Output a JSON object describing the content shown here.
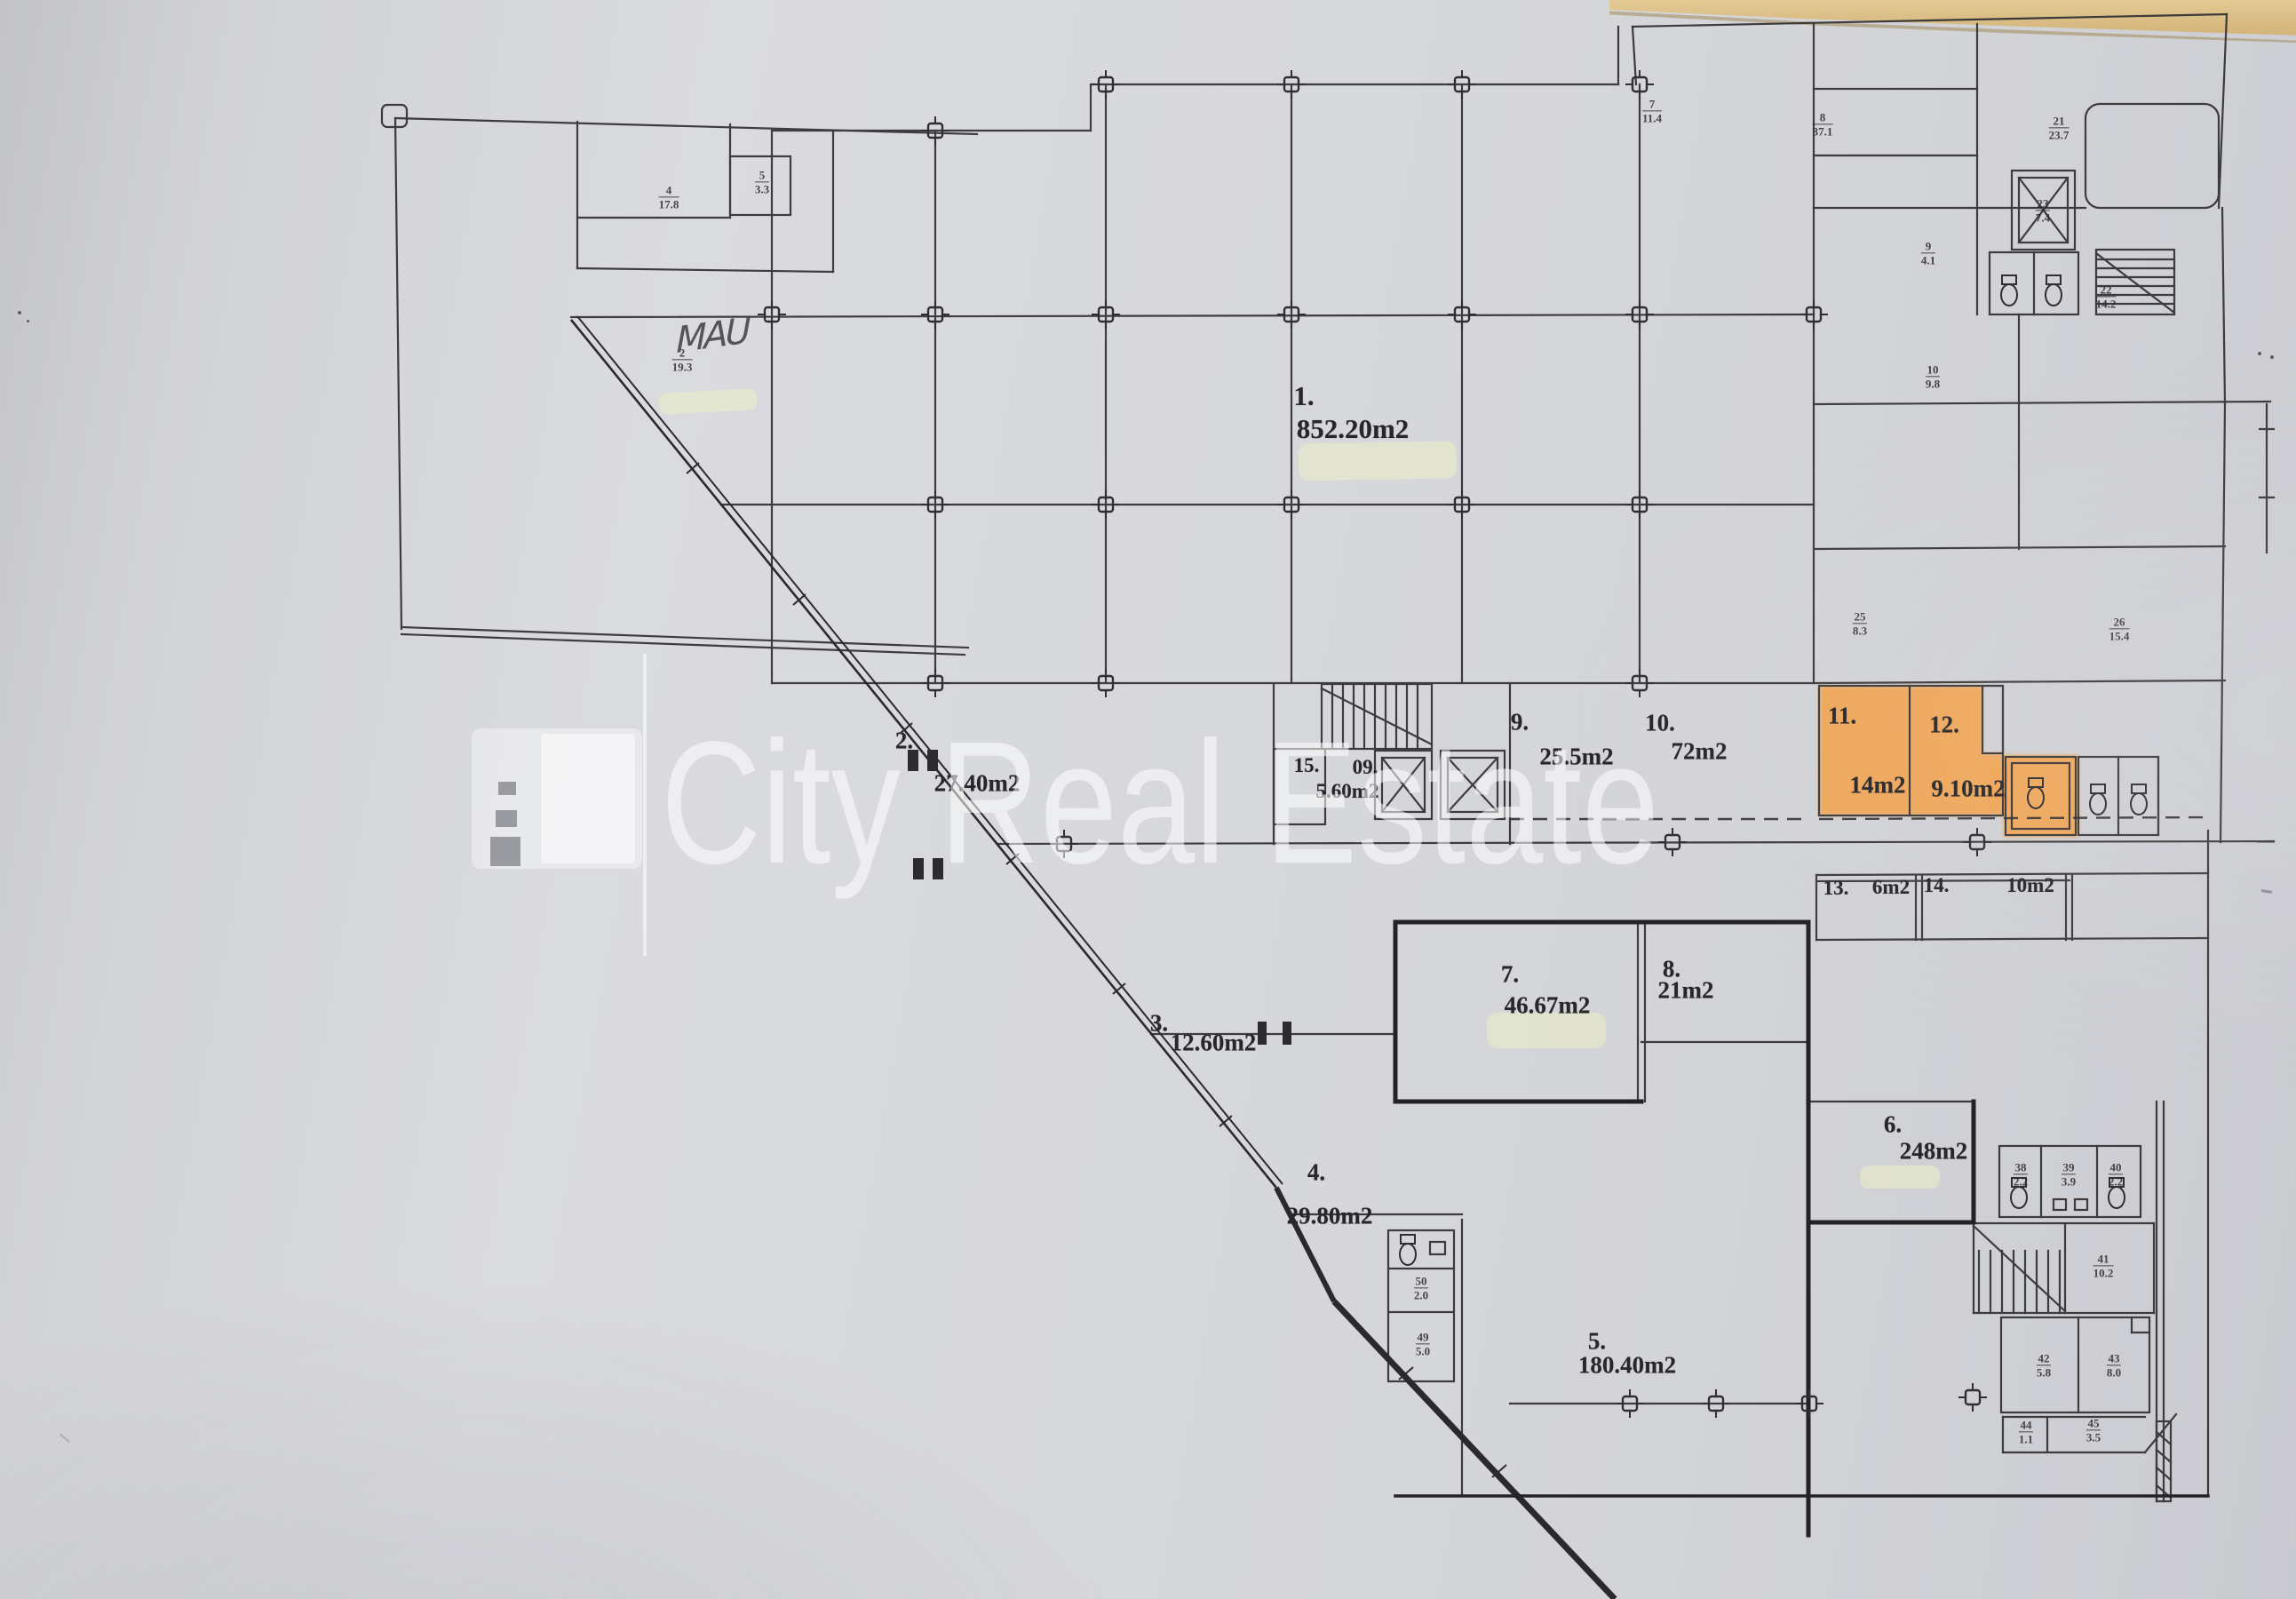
{
  "watermark": {
    "text": "City Real Estate",
    "color": "#ffffff"
  },
  "handwriting": {
    "text": "MAU"
  },
  "colors": {
    "paper": "#d6d7db",
    "desk": "#ddc28c",
    "ink": "#2f2f33",
    "highlight_orange": "#f5a149",
    "highlighter_yellow": "#e9edc6",
    "watermark_white": "#ffffff"
  },
  "rooms": [
    {
      "number": "1.",
      "area": "852.20m2"
    },
    {
      "number": "2.",
      "area": "27.40m2"
    },
    {
      "number": "3.",
      "area": "12.60m2"
    },
    {
      "number": "4.",
      "area": "29.80m2"
    },
    {
      "number": "5.",
      "area": "180.40m2"
    },
    {
      "number": "6.",
      "area": "248m2"
    },
    {
      "number": "7.",
      "area": "46.67m2"
    },
    {
      "number": "8.",
      "area": "21m2"
    },
    {
      "number": "9.",
      "area": "25.5m2"
    },
    {
      "number": "10.",
      "area": "72m2"
    },
    {
      "number": "11.",
      "area": "14m2"
    },
    {
      "number": "12.",
      "area": "9.10m2"
    },
    {
      "number": "13.",
      "area": "6m2"
    },
    {
      "number": "14.",
      "area": "10m2"
    },
    {
      "number": "15.",
      "area": "5.60m2"
    },
    {
      "number": "09.",
      "area": ""
    }
  ],
  "minor_rooms": [
    {
      "no": "4",
      "area": "17.8"
    },
    {
      "no": "5",
      "area": "3.3"
    },
    {
      "no": "2",
      "area": "19.3"
    },
    {
      "no": "7",
      "area": "11.4"
    },
    {
      "no": "8",
      "area": "37.1"
    },
    {
      "no": "21",
      "area": "23.7"
    },
    {
      "no": "9",
      "area": "4.1"
    },
    {
      "no": "10",
      "area": "9.8"
    },
    {
      "no": "22",
      "area": "14.2"
    },
    {
      "no": "23",
      "area": "7.4"
    },
    {
      "no": "25",
      "area": "8.3"
    },
    {
      "no": "26",
      "area": "15.4"
    },
    {
      "no": "38",
      "area": "2.2"
    },
    {
      "no": "39",
      "area": "3.9"
    },
    {
      "no": "40",
      "area": "2.2"
    },
    {
      "no": "41",
      "area": "10.2"
    },
    {
      "no": "42",
      "area": "5.8"
    },
    {
      "no": "43",
      "area": "8.0"
    },
    {
      "no": "44",
      "area": "1.1"
    },
    {
      "no": "45",
      "area": "3.5"
    },
    {
      "no": "50",
      "area": "2.0"
    },
    {
      "no": "49",
      "area": "5.0"
    }
  ]
}
